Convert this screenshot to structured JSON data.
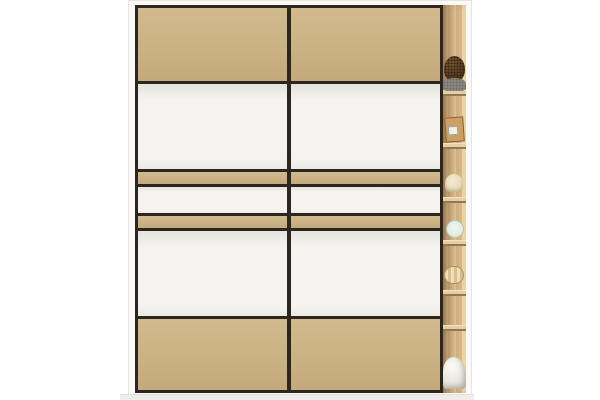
{
  "scene": {
    "background_color": "#ffffff",
    "floor_color": "#eeede9"
  },
  "wardrobe": {
    "frame_color": "#fbfaf7",
    "outline_color": "#2b2620",
    "panel_colors": {
      "tan": "#cbb285",
      "white": "#f4f3ef"
    },
    "panel_layout": [
      {
        "type": "tan",
        "height": 73
      },
      {
        "type": "white",
        "height": 85
      },
      {
        "type": "tan",
        "height": 12
      },
      {
        "type": "white",
        "height": 26
      },
      {
        "type": "tan",
        "height": 12
      },
      {
        "type": "white",
        "height": 85
      },
      {
        "type": "tan",
        "height": 0
      }
    ],
    "doors": [
      {
        "name": "sliding-door-left"
      },
      {
        "name": "sliding-door-right"
      }
    ],
    "side_unit": {
      "wood_color": "#d6b588",
      "shelf_color": "#e8cfa2",
      "shelf_positions": [
        85,
        138,
        192,
        235,
        285,
        320
      ],
      "items": [
        {
          "name": "wicker-ball",
          "y": 51
        },
        {
          "name": "fuzzy-gray-item",
          "y": 73
        },
        {
          "name": "storage-box",
          "y": 112
        },
        {
          "name": "cream-pouch",
          "y": 169
        },
        {
          "name": "decorative-plate",
          "y": 215
        },
        {
          "name": "round-box",
          "y": 261
        },
        {
          "name": "white-cloth",
          "y": 352
        }
      ]
    }
  }
}
